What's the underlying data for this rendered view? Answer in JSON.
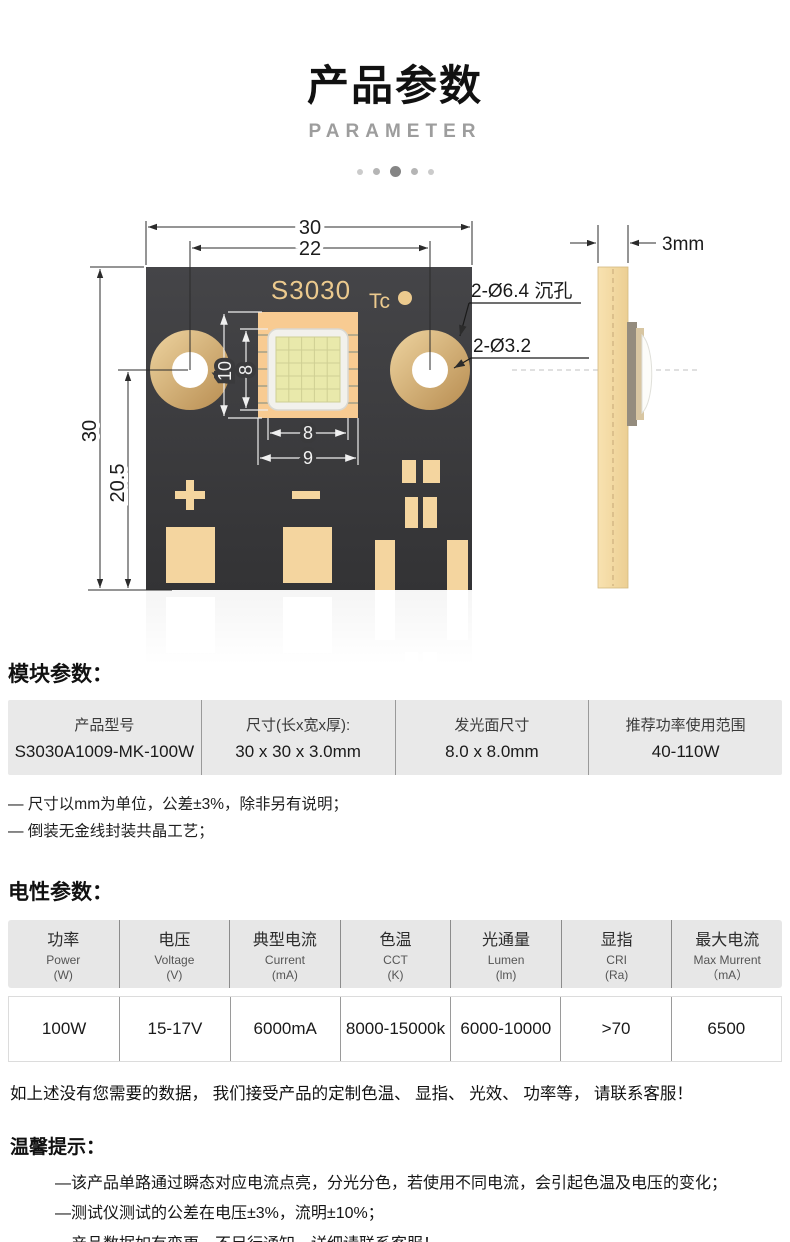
{
  "header": {
    "title": "产品参数",
    "subtitle": "PARAMETER"
  },
  "diagram": {
    "front": {
      "board_label": "S3030",
      "tc_label": "Tc"
    },
    "dims": {
      "board_width": "30",
      "hole_span": "22",
      "board_height": "30",
      "hole_to_bottom": "20.5",
      "emitter_outer_v": "10",
      "emitter_inner_v": "8",
      "emitter_inner_h": "8",
      "emitter_outer_h": "9"
    },
    "callouts": {
      "counterbore": "2-Ø6.4 沉孔",
      "through_hole": "2-Ø3.2",
      "thickness": "3mm"
    },
    "colors": {
      "board": "#3a3a3c",
      "pad_gold": "#f4d59f",
      "label_gold": "#ecca8e"
    }
  },
  "module_section": {
    "heading": "模块参数：",
    "table": [
      {
        "label": "产品型号",
        "value": "S3030A1009-MK-100W"
      },
      {
        "label": "尺寸(长x宽x厚):",
        "value": "30 x 30 x 3.0mm"
      },
      {
        "label": "发光面尺寸",
        "value": "8.0 x 8.0mm"
      },
      {
        "label": "推荐功率使用范围",
        "value": "40-110W"
      }
    ],
    "notes": [
      "— 尺寸以mm为单位，公差±3%，除非另有说明；",
      "— 倒装无金线封装共晶工艺；"
    ]
  },
  "electrical_section": {
    "heading": "电性参数：",
    "columns": [
      {
        "cn": "功率",
        "en": "Power",
        "unit": "(W)"
      },
      {
        "cn": "电压",
        "en": "Voltage",
        "unit": "(V)"
      },
      {
        "cn": "典型电流",
        "en": "Current",
        "unit": "(mA)"
      },
      {
        "cn": "色温",
        "en": "CCT",
        "unit": "(K)"
      },
      {
        "cn": "光通量",
        "en": "Lumen",
        "unit": "(lm)"
      },
      {
        "cn": "显指",
        "en": "CRI",
        "unit": "(Ra)"
      },
      {
        "cn": "最大电流",
        "en": "Max Murrent",
        "unit": "（mA）"
      }
    ],
    "values": [
      "100W",
      "15-17V",
      "6000mA",
      "8000-15000k",
      "6000-10000",
      ">70",
      "6500"
    ]
  },
  "footer": {
    "custom_note": "如上述没有您需要的数据， 我们接受产品的定制色温、 显指、 光效、 功率等， 请联系客服！",
    "tips_heading": "温馨提示：",
    "tips": [
      "—该产品单路通过瞬态对应电流点亮，分光分色，若使用不同电流，会引起色温及电压的变化；",
      "—测试仪测试的公差在电压±3%，流明±10%；",
      "—产品数据如有变更，不另行通知，详细请联系客服！"
    ]
  }
}
